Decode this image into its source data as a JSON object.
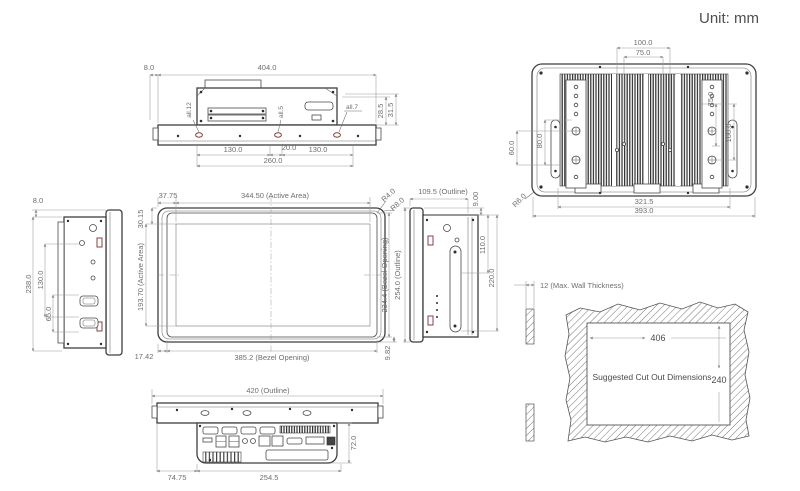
{
  "unit": "Unit: mm",
  "top": {
    "d_left": "8.0",
    "d_width": "404.0",
    "hole_l": "all.12",
    "hole_m": "all.5",
    "hole_r": "all.7",
    "d_h1": "28.5",
    "d_h2": "31.5",
    "d_b1": "130.0",
    "d_b2": "20.0",
    "d_b3": "130.0",
    "d_b4": "260.0"
  },
  "left": {
    "d_top": "8.0",
    "d_h": "238.0",
    "d_m": "130.0",
    "d_l": "65.0"
  },
  "front": {
    "d_ml": "37.75",
    "d_aw": "344.50 (Active Area)",
    "d_mt": "30.15",
    "r1": "R4.0",
    "r2": "R8.0",
    "d_ah": "193.70 (Active Area)",
    "d_bh": "234.4 (Bezel Opening)",
    "d_bl": "17.42",
    "d_bw": "385.2 (Bezel Opening)",
    "d_br": "9.82"
  },
  "right": {
    "d_depth": "109.5 (Outline)",
    "d_top": "9.00",
    "d_oh": "254.0 (Outline)",
    "d_slot": "110.0",
    "d_span": "220.0"
  },
  "rear": {
    "d_t1": "100.0",
    "d_t2": "75.0",
    "d_l1": "60.0",
    "d_l2": "80.0",
    "d_r1": "75.0",
    "d_r2": "100.0",
    "r": "R6.0",
    "d_b1": "321.5",
    "d_b2": "393.0"
  },
  "cutout": {
    "wall": "12 (Max. Wall Thickness)",
    "title": "Suggested Cut Out Dimensions",
    "w": "406",
    "h": "240"
  },
  "bottom": {
    "d_w": "420 (Outline)",
    "d_h": "72.0",
    "d_o": "74.75",
    "d_s": "254.5"
  }
}
